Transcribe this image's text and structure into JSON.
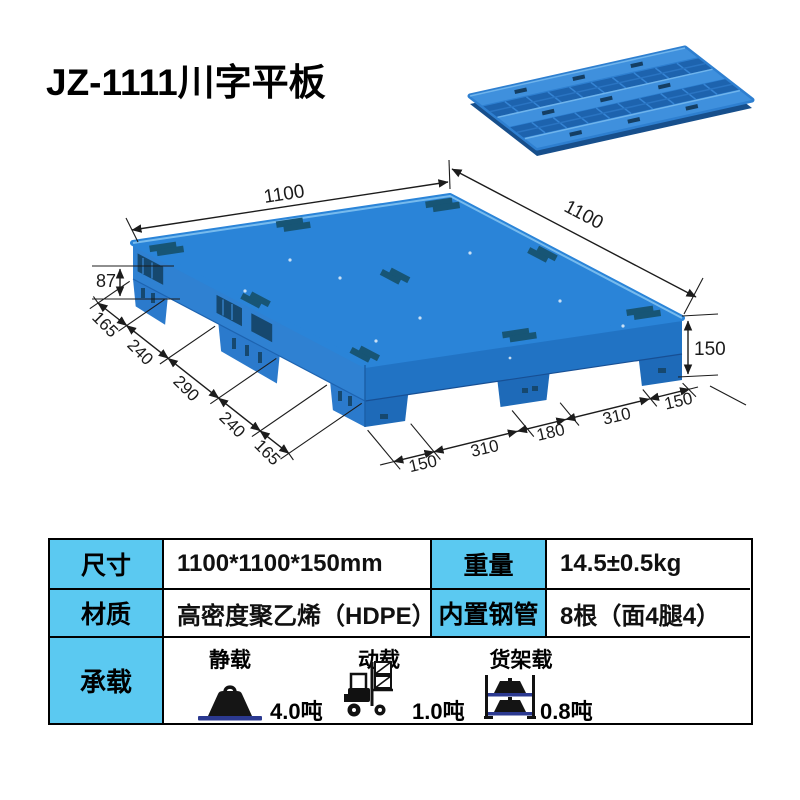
{
  "product": {
    "title": "JZ-1111川字平板"
  },
  "diagram": {
    "dims": {
      "top_left_edge": "1100",
      "top_right_edge": "1100",
      "deck_thickness": "87",
      "right_height": "150",
      "left_segments": [
        "165",
        "240",
        "290",
        "240",
        "165"
      ],
      "bottom_segments": [
        "150",
        "310",
        "180",
        "310",
        "150"
      ]
    }
  },
  "spec_table": {
    "rows": [
      {
        "label1": "尺寸",
        "value1": "1100*1100*150mm",
        "label2": "重量",
        "value2": "14.5±0.5kg"
      },
      {
        "label1": "材质",
        "value1": "高密度聚乙烯（HDPE）",
        "label2": "内置钢管",
        "value2": "8根（面4腿4）"
      }
    ],
    "load": {
      "label": "承载",
      "items": [
        {
          "name": "静载",
          "value": "4.0吨",
          "icon": "weight-icon"
        },
        {
          "name": "动载",
          "value": "1.0吨",
          "icon": "forklift-icon"
        },
        {
          "name": "货架载",
          "value": "0.8吨",
          "icon": "rack-icon"
        }
      ]
    }
  },
  "colors": {
    "table_header_bg": "#5bc9f1",
    "pallet_blue": "#2a84d8",
    "pallet_left_face": "#2f81d2",
    "pallet_right_face": "#2173c4",
    "slot_dark": "#175575",
    "steel_base_blue": "#2b3990",
    "line_color": "#1c1c1c"
  }
}
